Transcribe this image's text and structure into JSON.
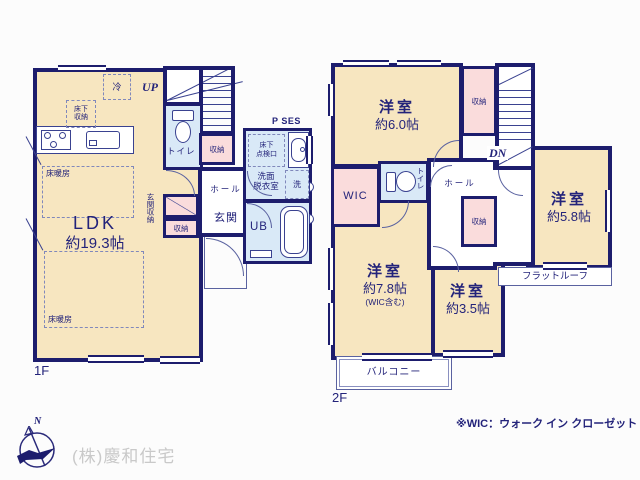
{
  "palette": {
    "wall": "#1d1d6d",
    "room_fill": "#f7e6c0",
    "wet_area_fill": "#d9e9f7",
    "closet_fill": "#fadcdc",
    "text": "#23237a",
    "company_text": "#c9c9c9"
  },
  "floor1": {
    "floor_label": "1F",
    "ldk_name": "LDK",
    "ldk_area": "約19.3帖",
    "fridge": "冷",
    "underfloor_storage": "床下\n収納",
    "floor_heating_a": "床暖房",
    "floor_heating_b": "床暖房",
    "stairs_up": "UP",
    "toilet": "トイレ",
    "stair_closet": "収納",
    "hall": "ホール",
    "entrance": "玄関",
    "entrance_closet_label": "玄関収納",
    "entrance_closet2": "収納",
    "pipe_space": "P SES",
    "underfloor_access": "床下\n点検口",
    "washroom": "洗面\n脱衣室",
    "washer": "洗",
    "unit_bath": "UB"
  },
  "floor2": {
    "floor_label": "2F",
    "room6_name": "洋室",
    "room6_area": "約6.0帖",
    "top_closet": "収納",
    "stairs_down": "DN",
    "wic": "WIC",
    "toilet": "トイレ",
    "hall": "ホール",
    "mid_closet": "収納",
    "room58_name": "洋室",
    "room58_area": "約5.8帖",
    "flat_roof": "フラットルーフ",
    "room78_name": "洋室",
    "room78_area": "約7.8帖",
    "room78_note": "(WIC含む)",
    "room35_name": "洋室",
    "room35_area": "約3.5帖",
    "balcony": "バルコニー"
  },
  "footer": {
    "compass_north": "N",
    "company": "(株)慶和住宅",
    "wic_note": "※WIC：ウォーク イン クローゼット"
  }
}
